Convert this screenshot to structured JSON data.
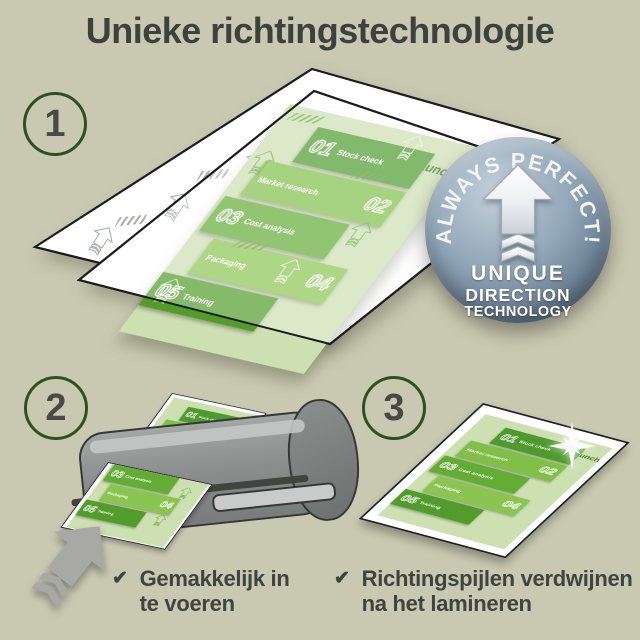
{
  "title": "Unieke richtingstechnologie",
  "steps": [
    {
      "number": "1"
    },
    {
      "number": "2"
    },
    {
      "number": "3"
    }
  ],
  "badge": {
    "arc_text": "ALWAYS PERFECT!",
    "line1": "UNIQUE",
    "line2": "DIRECTION",
    "line3": "TECHNOLOGY"
  },
  "document": {
    "launch": "Launch",
    "panels": [
      {
        "num": "01",
        "label": "Stock check"
      },
      {
        "num": "02",
        "label": "Market research"
      },
      {
        "num": "03",
        "label": "Cost analysis"
      },
      {
        "num": "04",
        "label": "Packaging"
      },
      {
        "num": "05",
        "label": "Training"
      }
    ]
  },
  "captions": [
    {
      "check": "✔",
      "line1": "Gemakkelijk in",
      "line2": "te voeren"
    },
    {
      "check": "✔",
      "line1": "Richtingspijlen verdwijnen",
      "line2": "na het lamineren"
    }
  ],
  "palette": {
    "background": "#c9c9b1",
    "title_text": "#3d423f",
    "step_ring_green": "#2b5124",
    "page_green": "#cde0b2",
    "panel_green_dark": "#4e9b2d",
    "panel_green_bright": "#8ac551",
    "launch_green": "#3a7c1a",
    "badge_blue_light": "#c4d0da",
    "badge_blue_dark": "#47586a",
    "machine_gray": "#8b908e",
    "feed_arrow_gray": "#a8a9a4"
  }
}
